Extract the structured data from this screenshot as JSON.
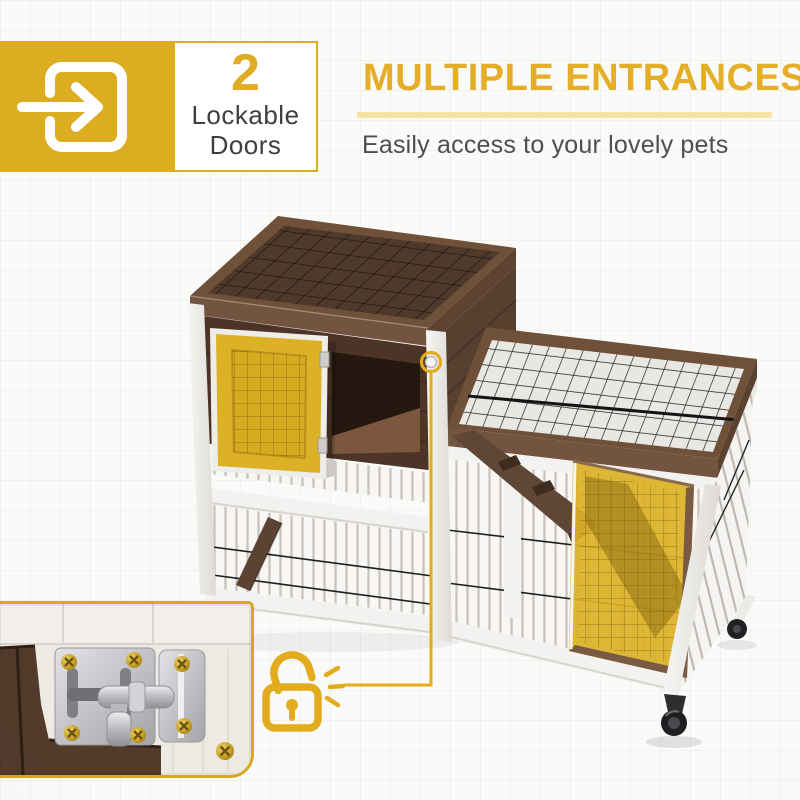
{
  "badge": {
    "count": "2",
    "line1": "Lockable",
    "line2": "Doors"
  },
  "header": {
    "title": "MULTIPLE ENTRANCES",
    "subtitle": "Easily access to your lovely pets"
  },
  "icons": {
    "badge_icon": "door-enter-arrow-icon",
    "callout_icon": "unlocked-padlock-icon"
  },
  "colors": {
    "accent": "#DCAC21",
    "heading": "#E5AE29",
    "underline": "#F5E3A6",
    "badge_number": "#DFAC24",
    "text_dark": "#3F3F3F",
    "text_gray": "#4E4E4E",
    "door_highlight": "#DCB125",
    "wood_brown": "#5E4330",
    "frame_white": "#F3F2F0"
  },
  "scene": {
    "photo": "two-tier wooden pet hutch with wire mesh, two yellow-highlighted lockable doors, ramp and caster wheels",
    "inset": "close-up of sliding barrel-bolt door latch"
  }
}
